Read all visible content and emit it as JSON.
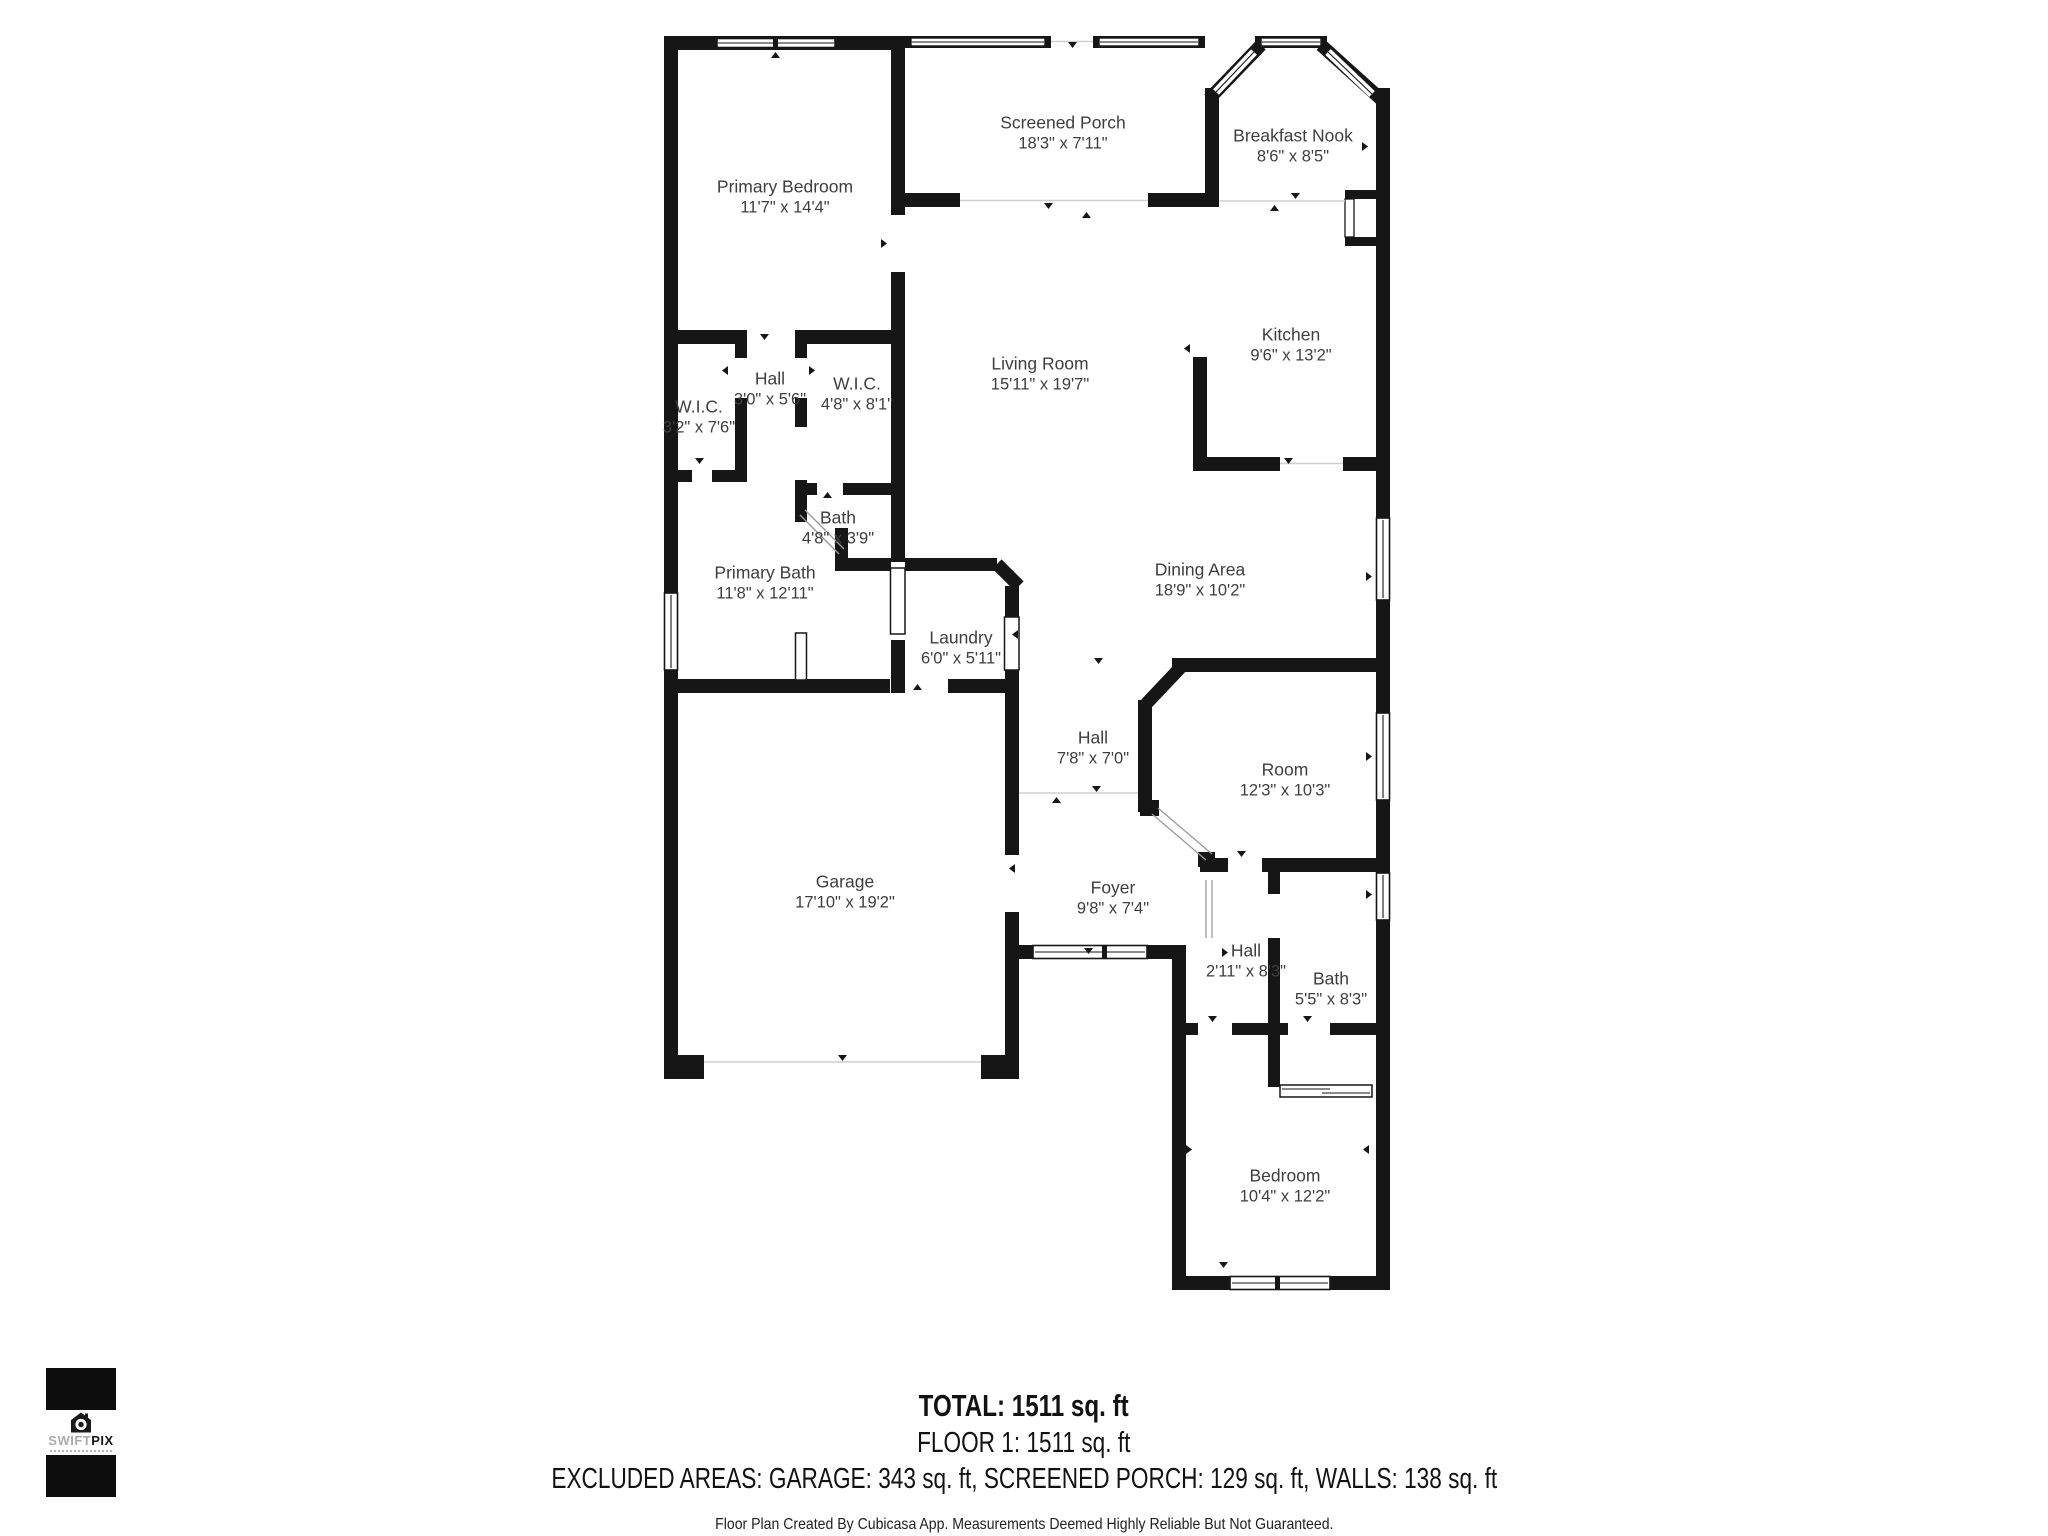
{
  "floor_plan": {
    "rooms": [
      {
        "name": "Primary Bedroom",
        "dims": "11'7\" x 14'4\""
      },
      {
        "name": "Screened Porch",
        "dims": "18'3\" x 7'11\""
      },
      {
        "name": "Breakfast Nook",
        "dims": "8'6\" x 8'5\""
      },
      {
        "name": "Kitchen",
        "dims": "9'6\" x 13'2\""
      },
      {
        "name": "Living Room",
        "dims": "15'11\" x 19'7\""
      },
      {
        "name": "Hall",
        "dims": "3'0\" x 5'6\""
      },
      {
        "name": "W.I.C.",
        "dims": "4'8\" x 8'1\""
      },
      {
        "name": "W.I.C.",
        "dims": "3'2\" x 7'6\""
      },
      {
        "name": "Bath",
        "dims": "4'8\" x 3'9\""
      },
      {
        "name": "Primary Bath",
        "dims": "11'8\" x 12'11\""
      },
      {
        "name": "Laundry",
        "dims": "6'0\" x 5'11\""
      },
      {
        "name": "Dining Area",
        "dims": "18'9\" x 10'2\""
      },
      {
        "name": "Hall",
        "dims": "7'8\" x 7'0\""
      },
      {
        "name": "Room",
        "dims": "12'3\" x 10'3\""
      },
      {
        "name": "Garage",
        "dims": "17'10\" x 19'2\""
      },
      {
        "name": "Foyer",
        "dims": "9'8\" x 7'4\""
      },
      {
        "name": "Hall",
        "dims": "2'11\" x 8'3\""
      },
      {
        "name": "Bath",
        "dims": "5'5\" x 8'3\""
      },
      {
        "name": "Bedroom",
        "dims": "10'4\" x 12'2\""
      }
    ],
    "summary": {
      "total": "TOTAL: 1511 sq. ft",
      "floor": "FLOOR 1: 1511 sq. ft",
      "excluded": "EXCLUDED AREAS: GARAGE: 343 sq. ft, SCREENED PORCH: 129 sq. ft, WALLS: 138 sq. ft",
      "disclaimer": "Floor Plan Created By Cubicasa App. Measurements Deemed Highly Reliable But Not Guaranteed."
    },
    "logo": {
      "brand_primary": "SWIFT",
      "brand_secondary": "PIX"
    },
    "colors": {
      "wall": "#161616",
      "label": "#3e3e3e",
      "opening_line": "#cfcfcf"
    }
  }
}
